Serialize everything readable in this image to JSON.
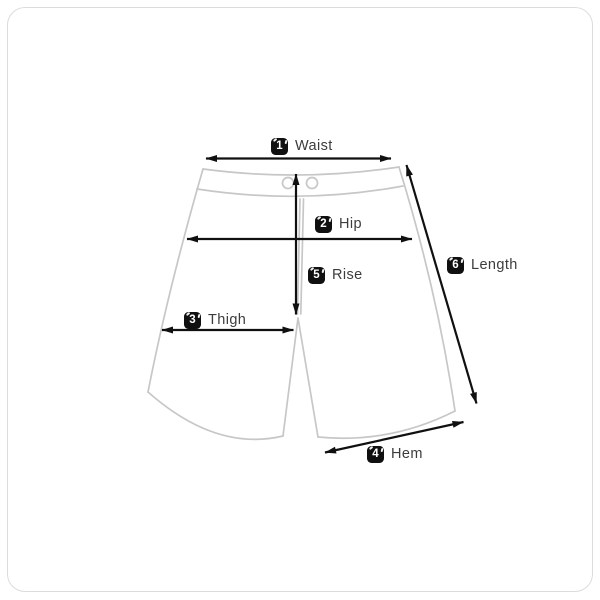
{
  "page": {
    "title": "Shorts size guide diagram",
    "background": "#ffffff",
    "frame_border_color": "#dcdcdc"
  },
  "diagram": {
    "garment": "shorts",
    "outline_color": "#c7c7c7",
    "arrow_color": "#101010",
    "badge_bg": "#101010",
    "badge_text_color": "#ffffff",
    "label_color": "#3c3c3c",
    "measurements": [
      {
        "number": "1",
        "label": "Waist"
      },
      {
        "number": "2",
        "label": "Hip"
      },
      {
        "number": "3",
        "label": "Thigh"
      },
      {
        "number": "4",
        "label": "Hem"
      },
      {
        "number": "5",
        "label": "Rise"
      },
      {
        "number": "6",
        "label": "Length"
      }
    ]
  }
}
